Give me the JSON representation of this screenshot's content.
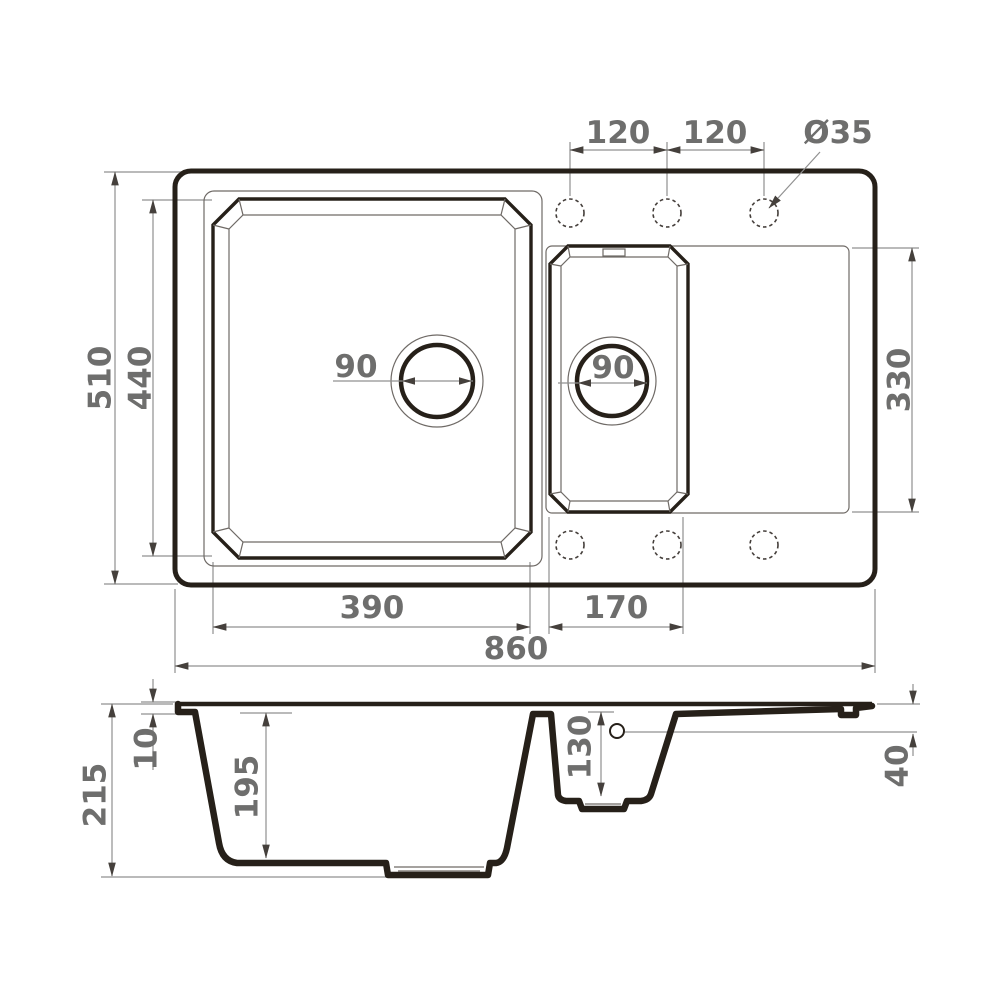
{
  "plan": {
    "faucet_hole_spacing_1": "120",
    "faucet_hole_spacing_2": "120",
    "faucet_hole_diameter": "Ø35",
    "overall_depth": "510",
    "main_bowl_inner_depth": "440",
    "main_bowl_width": "390",
    "small_bowl_width": "170",
    "drainboard_depth": "330",
    "main_drain_diameter": "90",
    "small_drain_diameter": "90",
    "overall_width": "860"
  },
  "section": {
    "overall_height": "215",
    "rim_height": "10",
    "main_bowl_depth": "195",
    "small_bowl_depth": "130",
    "drainboard_edge_height": "40"
  },
  "colors": {
    "outline": "#262019",
    "dimension_line": "#909090",
    "dimension_text": "#6e6e6d"
  }
}
